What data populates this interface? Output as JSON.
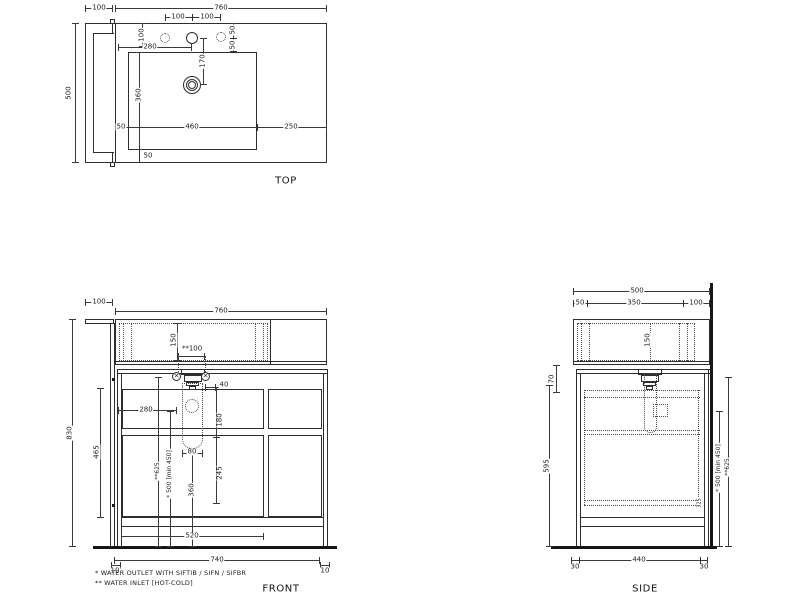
{
  "icons": {
    "valve": "✕"
  },
  "drawing": {
    "titles": {
      "top": "TOP",
      "front": "FRONT",
      "side": "SIDE"
    },
    "footnotes": {
      "line1": "*  WATER OUTLET WITH SIFTIB / SIFN / SIFBR",
      "line2": "** WATER INLET [HOT-COLD]"
    },
    "top": {
      "panel_width": "100",
      "overall_width": "760",
      "overall_depth": "500",
      "hole_spacing_left": "100",
      "hole_spacing_right": "100",
      "hole_from_top": "100",
      "faucet_from_left": "280",
      "right_hole_upper": "50",
      "right_hole_lower": "50",
      "drain_from_faucet": "170",
      "basin_depth": "360",
      "basin_left_gap": "50",
      "basin_width": "460",
      "right_overhang": "250",
      "basin_bottom_gap": "50"
    },
    "front": {
      "panel_width": "100",
      "overall_width": "760",
      "overall_height": "830",
      "basin_inner_depth": "150",
      "inlet_spacing": "**100",
      "drain_offset": "40",
      "drain_from_left": "280",
      "inlet_drop": "180",
      "side_inner": "465",
      "inlet_height": "**625",
      "outlet_height": "* 500 [min 450]",
      "trap_width": "80",
      "trap_height": "360",
      "dim_245": "245",
      "drawer_width": "520",
      "base_width": "740",
      "gap_left": "10",
      "gap_right": "10"
    },
    "side": {
      "overall_depth": "500",
      "front_gap": "50",
      "basin_span": "350",
      "back_span": "100",
      "basin_inner_depth": "150",
      "top_offset": "70",
      "cabinet_height": "595",
      "outlet_height": "* 500 [min 450]",
      "inlet_height": "**625",
      "inner_dim": "325",
      "base_depth": "440",
      "gap_front": "30",
      "gap_back": "30"
    }
  }
}
